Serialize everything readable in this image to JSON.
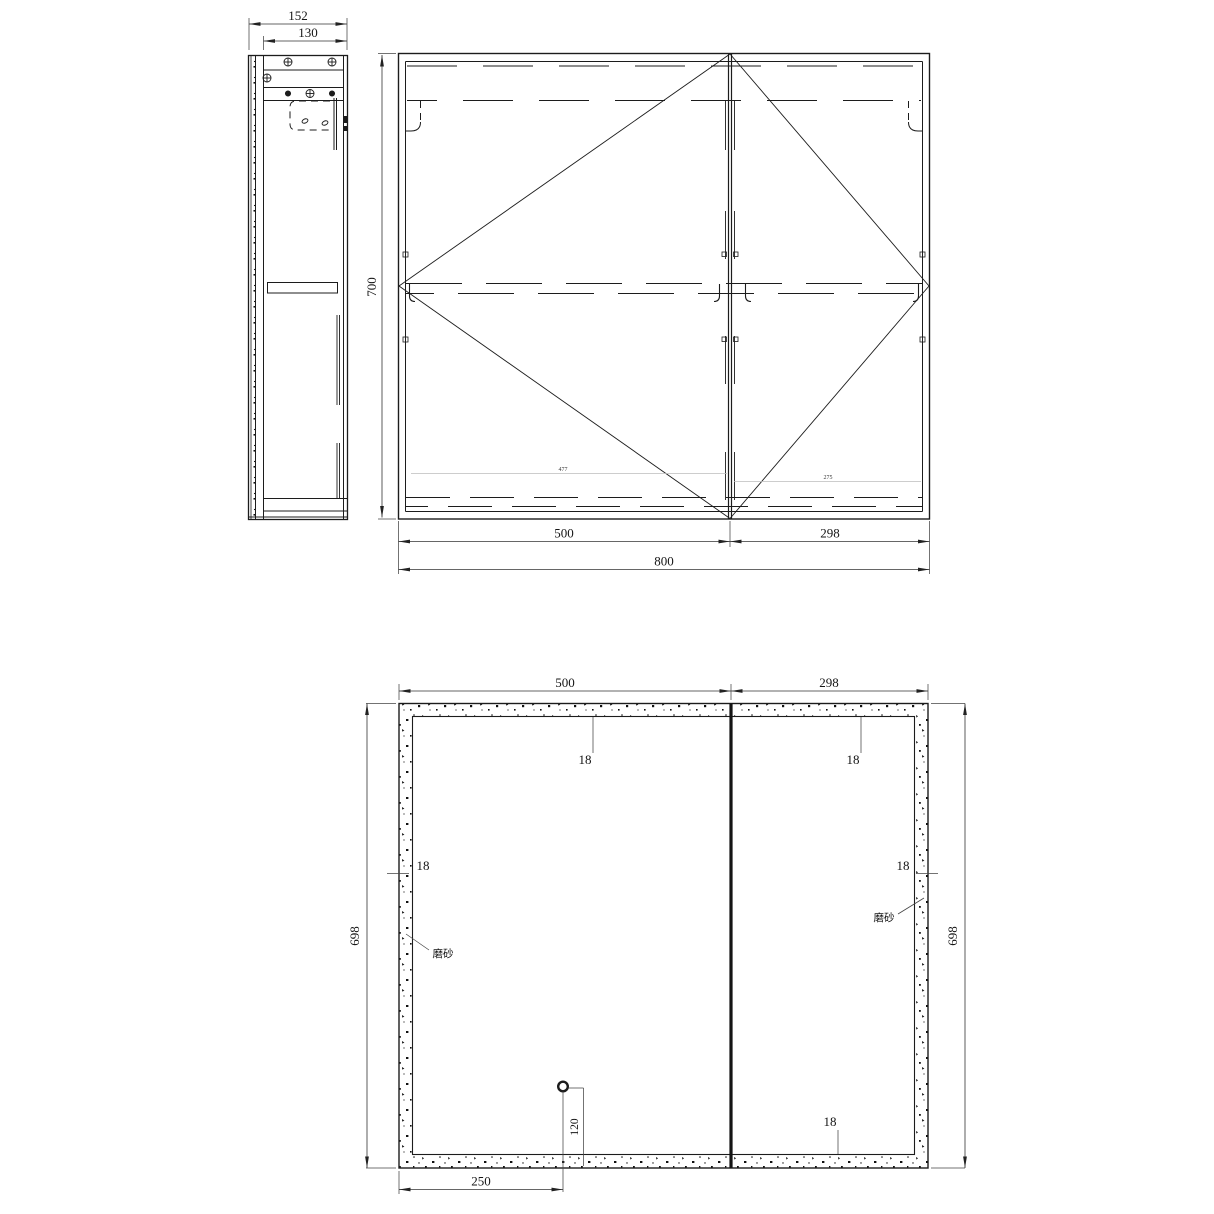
{
  "side_view": {
    "dim_overall_depth": "152",
    "dim_body_depth": "130"
  },
  "front_view": {
    "dim_height": "700",
    "dim_left_door_width": "500",
    "dim_right_door_width": "298",
    "dim_overall_width": "800",
    "dim_left_inner_width": "477",
    "dim_right_inner_width": "275"
  },
  "panel_view": {
    "dim_left_width": "500",
    "dim_right_width": "298",
    "dim_left_height": "698",
    "dim_right_height": "698",
    "dim_border_top_left": "18",
    "dim_border_top_right": "18",
    "dim_border_side_left": "18",
    "dim_border_side_right": "18",
    "dim_border_bottom": "18",
    "dim_hole_from_bottom": "120",
    "dim_hole_from_left": "250",
    "label_frosted_left": "磨砂",
    "label_frosted_right": "磨砂"
  },
  "colors": {
    "background": "#ffffff",
    "line": "#1c1c1c",
    "dim_line": "#333333"
  }
}
